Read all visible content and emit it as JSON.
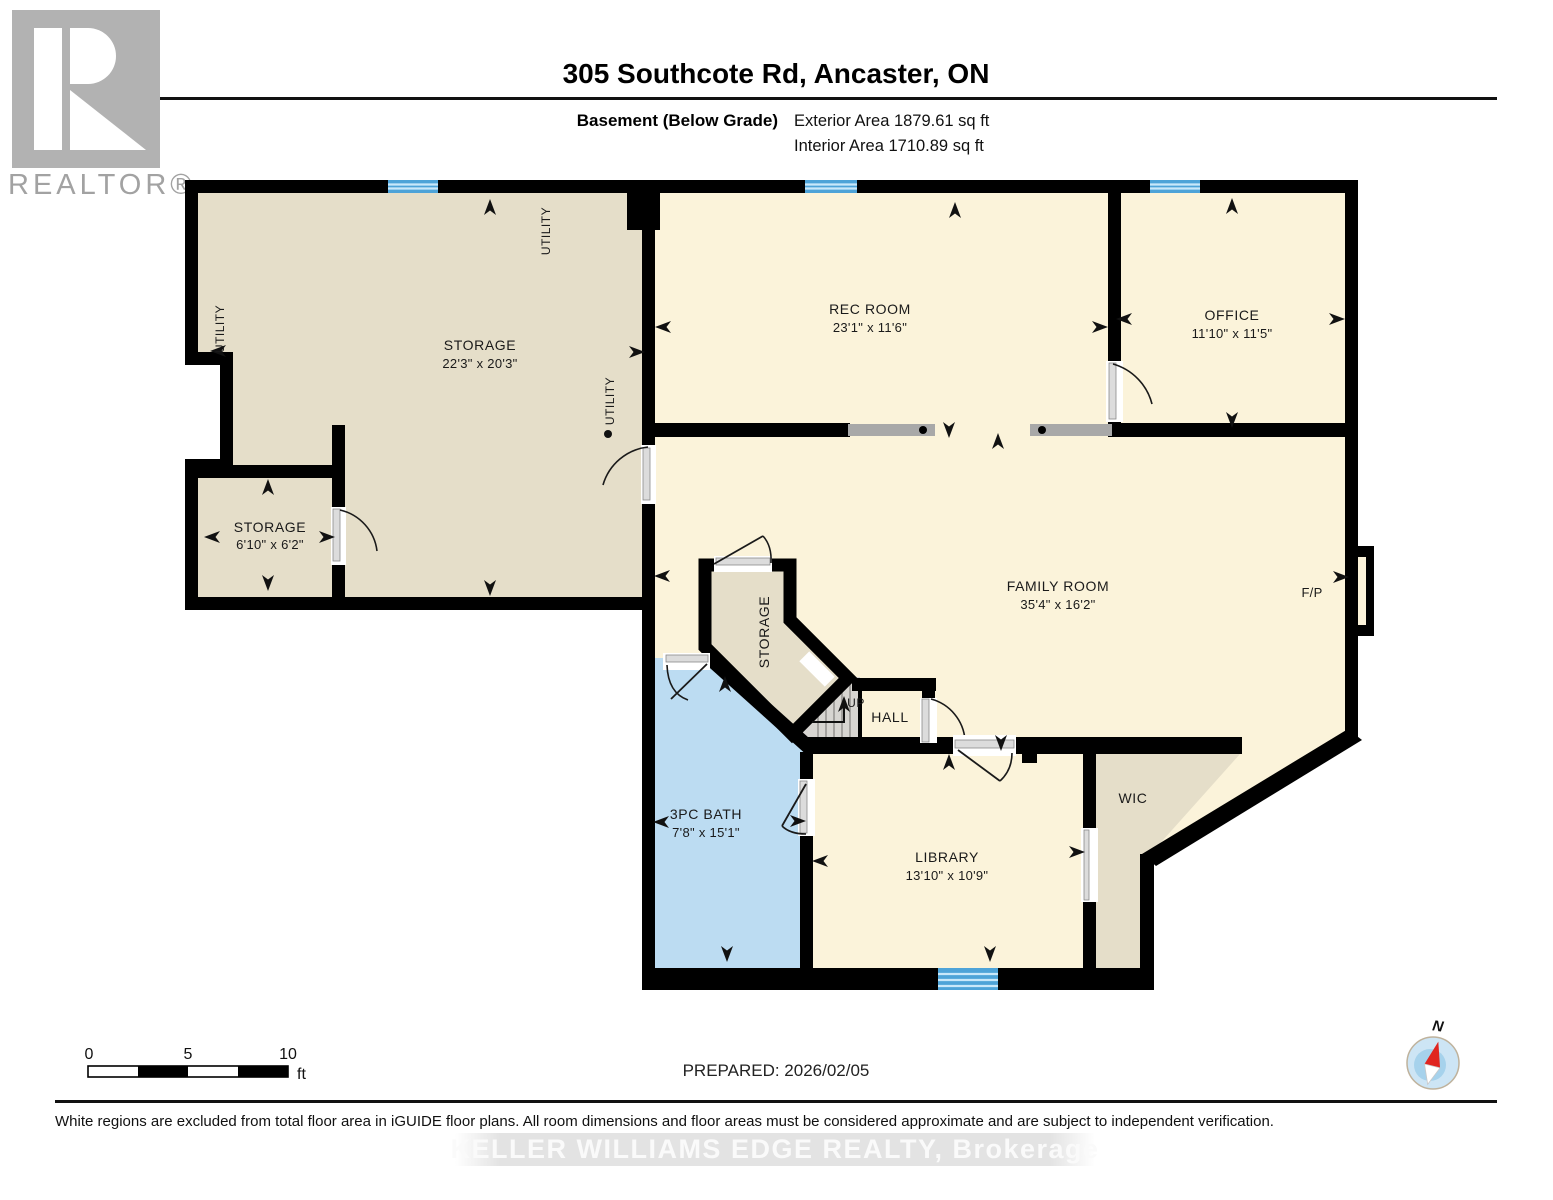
{
  "header": {
    "title": "305 Southcote Rd, Ancaster, ON",
    "floor_label": "Basement (Below Grade)",
    "exterior_area": "Exterior Area 1879.61 sq ft",
    "interior_area": "Interior Area 1710.89 sq ft"
  },
  "logo": {
    "text": "REALTOR®"
  },
  "rooms": {
    "storage_main": {
      "name": "STORAGE",
      "dims": "22'3\" x 20'3\""
    },
    "storage_small": {
      "name": "STORAGE",
      "dims": "6'10\" x 6'2\""
    },
    "rec_room": {
      "name": "REC ROOM",
      "dims": "23'1\" x 11'6\""
    },
    "office": {
      "name": "OFFICE",
      "dims": "11'10\" x 11'5\""
    },
    "family_room": {
      "name": "FAMILY ROOM",
      "dims": "35'4\" x 16'2\""
    },
    "storage_diagonal": {
      "name": "STORAGE"
    },
    "hall": {
      "name": "HALL"
    },
    "stairs": {
      "label": "UP"
    },
    "bath": {
      "name": "3PC BATH",
      "dims": "7'8\" x 15'1\""
    },
    "library": {
      "name": "LIBRARY",
      "dims": "13'10\" x 10'9\""
    },
    "wic": {
      "name": "WIC"
    },
    "fireplace": {
      "label": "F/P"
    }
  },
  "annotations": {
    "utility_left": "UTILITY",
    "utility_top": "UTILITY",
    "utility_right": "UTILITY"
  },
  "scale_bar": {
    "tick0": "0",
    "tick5": "5",
    "tick10": "10",
    "unit": "ft"
  },
  "compass": {
    "north": "N"
  },
  "footer": {
    "prepared": "PREPARED: 2026/02/05",
    "disclaimer": "White regions are excluded from total floor area in iGUIDE floor plans. All room dimensions and floor areas must be considered approximate and are subject to independent verification.",
    "watermark": "KELLER WILLIAMS EDGE REALTY, Brokerage"
  },
  "colors": {
    "wall": "#000000",
    "floor_cream": "#fbf3da",
    "floor_beige": "#e5dec9",
    "floor_bath_blue": "#bcdcf2",
    "stairs_gray": "#d7d5d1",
    "window_blue": "#4da3d8",
    "pocket_door_gray": "#a8a8a8",
    "logo_gray": "#b2b2b2",
    "watermark_gray": "#e3e3e3",
    "compass_blue": "#cde5f5",
    "compass_needle_red": "#e02520"
  }
}
